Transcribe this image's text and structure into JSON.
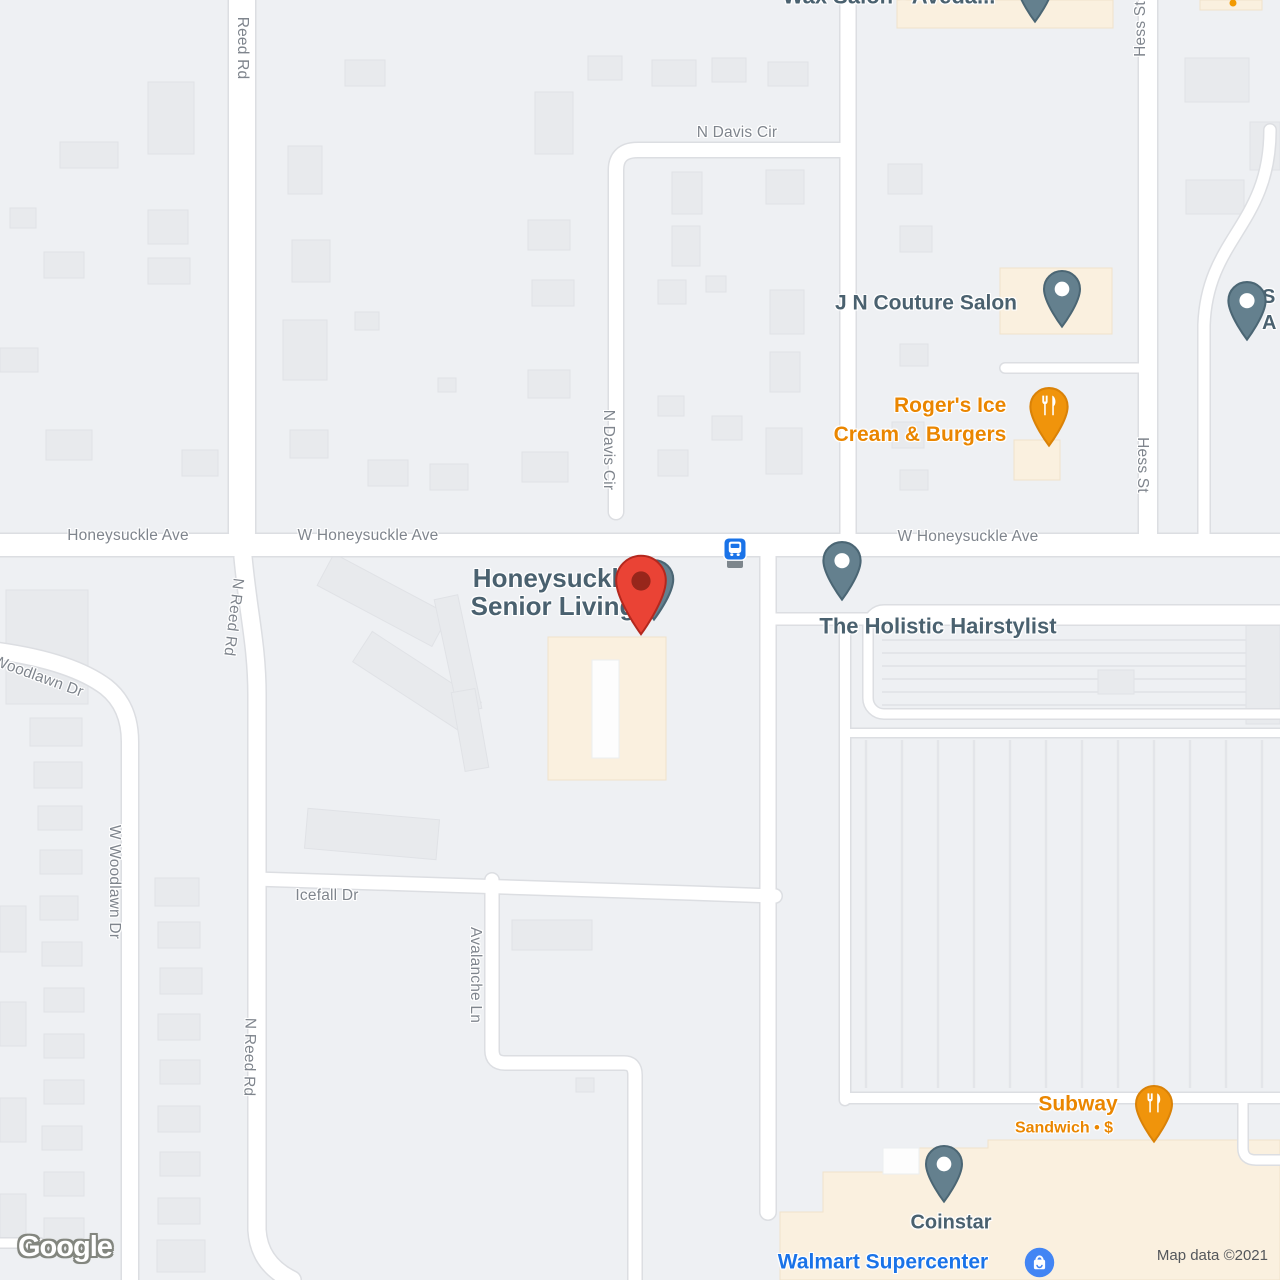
{
  "streets": [
    {
      "name": "Reed Rd"
    },
    {
      "name": "N Davis Cir"
    },
    {
      "name": "N Davis Cir"
    },
    {
      "name": "Hess St"
    },
    {
      "name": "Hess St"
    },
    {
      "name": "Honeysuckle Ave"
    },
    {
      "name": "W Honeysuckle Ave"
    },
    {
      "name": "W Honeysuckle Ave"
    },
    {
      "name": "Woodlawn Dr"
    },
    {
      "name": "W Woodlawn Dr"
    },
    {
      "name": "N Reed Rd"
    },
    {
      "name": "N Reed Rd"
    },
    {
      "name": "Icefall Dr"
    },
    {
      "name": "Avalanche Ln"
    }
  ],
  "pois": {
    "wax_salon": {
      "label": "Wax Salon - Aveda..."
    },
    "jn_couture_salon": {
      "label": "J N Couture Salon"
    },
    "rogers": {
      "line1": "Roger's Ice",
      "line2": "Cream & Burgers"
    },
    "honeysuckle_senior_living": {
      "line1": "Honeysuckle",
      "line2": "Senior Living"
    },
    "holistic_hairstylist": {
      "label": "The Holistic Hairstylist"
    },
    "subway": {
      "label": "Subway",
      "subtitle": "Sandwich • $"
    },
    "coinstar": {
      "label": "Coinstar"
    },
    "walmart": {
      "label": "Walmart Supercenter"
    },
    "edge_poi": {
      "line1": "S",
      "line2": "A"
    }
  },
  "transit": {
    "bus_stop": "bus-stop"
  },
  "attribution": {
    "text": "Map data ©2021"
  },
  "logo": {
    "text": "Google"
  },
  "icons": {
    "place_pin": "place-pin-icon",
    "restaurant_pin": "fork-knife-pin-icon",
    "destination_marker": "red-destination-marker-icon",
    "bus": "bus-icon",
    "shopping_bag": "shopping-bag-icon"
  },
  "colors": {
    "poi_label": "#4a616f",
    "street_label": "#7f858d",
    "restaurant_orange": "#ea8600",
    "google_blue": "#1a73e8",
    "marker_red": "#ea4335",
    "pin_slate": "#64808e",
    "commercial_fill": "#faf0df",
    "building_fill": "#e8eaed",
    "road_fill": "#ffffff"
  }
}
